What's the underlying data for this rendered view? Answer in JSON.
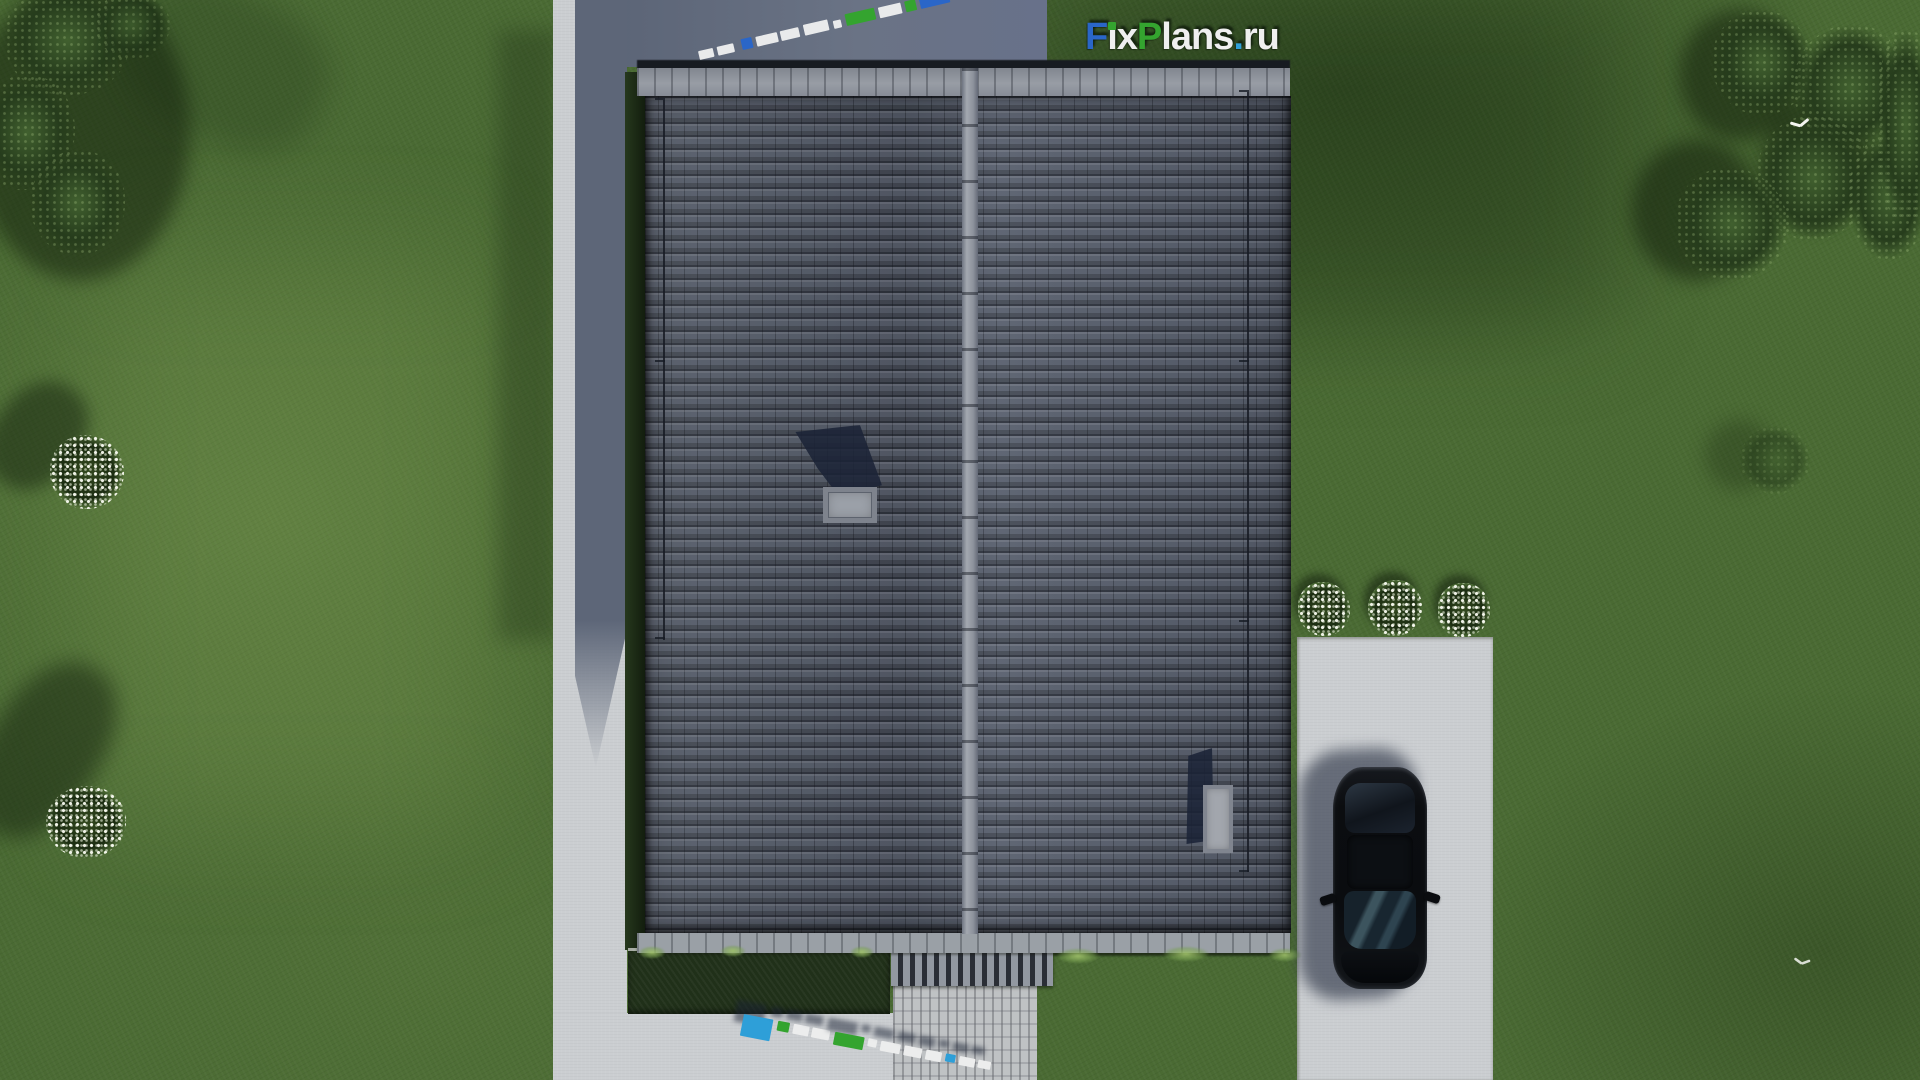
{
  "scene": {
    "description": "Aerial top-down 3D architectural render: house with dark gray tiled gable roof, green lawn, trees, concrete paths, driveway with black car, white flower bushes",
    "colors": {
      "brand_blue": "#2a66c8",
      "brand_green": "#34a42f",
      "brand_light_blue": "#2f9fd7",
      "logo_white": "#efefef",
      "lawn": "#4a6a33",
      "roof": "#59606e",
      "concrete": "#cbced1",
      "concrete_shadow": "#616a7c",
      "car": "#0b0d10"
    }
  },
  "logo": {
    "text": "FixPlans.ru",
    "segments": [
      {
        "text": "F",
        "color": "#2a66c8"
      },
      {
        "text": "ı",
        "color": "#efefef",
        "dot": "#34a42f"
      },
      {
        "text": "x",
        "color": "#efefef"
      },
      {
        "text": "P",
        "color": "#34a42f"
      },
      {
        "text": "lans",
        "color": "#efefef"
      },
      {
        "text": ".",
        "color": "#2f9fd7"
      },
      {
        "text": "ru",
        "color": "#efefef"
      }
    ]
  },
  "watermarks": {
    "top": {
      "angle": -13,
      "blocks": [
        {
          "w": 15,
          "h": 9,
          "c": "#e9eaeb",
          "g": 4
        },
        {
          "w": 17,
          "h": 9,
          "c": "#e9eaeb",
          "g": 8
        },
        {
          "w": 11,
          "h": 11,
          "c": "#2a66c8",
          "g": 4
        },
        {
          "w": 22,
          "h": 10,
          "c": "#e9eaeb",
          "g": 3
        },
        {
          "w": 19,
          "h": 10,
          "c": "#e9eaeb",
          "g": 5
        },
        {
          "w": 25,
          "h": 11,
          "c": "#e9eaeb",
          "g": 5
        },
        {
          "w": 8,
          "h": 8,
          "c": "#e9eaeb",
          "g": 5
        },
        {
          "w": 30,
          "h": 12,
          "c": "#34a42f",
          "g": 4
        },
        {
          "w": 23,
          "h": 11,
          "c": "#e9eaeb",
          "g": 4
        },
        {
          "w": 11,
          "h": 11,
          "c": "#34a42f",
          "g": 4
        },
        {
          "w": 30,
          "h": 20,
          "c": "#2a66c8",
          "g": 0
        }
      ]
    },
    "bottom": {
      "angle": 11,
      "blocks": [
        {
          "w": 30,
          "h": 22,
          "c": "#2e9fd8",
          "g": 5
        },
        {
          "w": 12,
          "h": 10,
          "c": "#34a42f",
          "g": 4
        },
        {
          "w": 16,
          "h": 10,
          "c": "#eceded",
          "g": 3
        },
        {
          "w": 18,
          "h": 10,
          "c": "#eceded",
          "g": 5
        },
        {
          "w": 30,
          "h": 13,
          "c": "#34a42f",
          "g": 4
        },
        {
          "w": 9,
          "h": 8,
          "c": "#eceded",
          "g": 4
        },
        {
          "w": 20,
          "h": 10,
          "c": "#eceded",
          "g": 4
        },
        {
          "w": 18,
          "h": 10,
          "c": "#eceded",
          "g": 4
        },
        {
          "w": 16,
          "h": 10,
          "c": "#eceded",
          "g": 4
        },
        {
          "w": 10,
          "h": 8,
          "c": "#2e9fd8",
          "g": 4
        },
        {
          "w": 16,
          "h": 9,
          "c": "#eceded",
          "g": 3
        },
        {
          "w": 13,
          "h": 8,
          "c": "#eceded",
          "g": 0
        }
      ]
    }
  }
}
